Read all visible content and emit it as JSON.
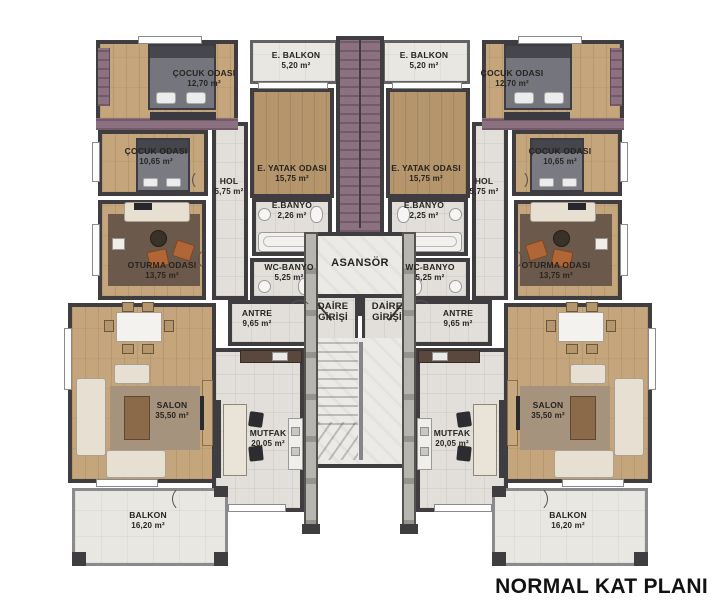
{
  "title": "NORMAL KAT PLANI",
  "core": {
    "asansor_label": "ASANSÖR",
    "daire_line1": "DAİRE",
    "daire_line2": "GİRİŞİ"
  },
  "rooms": {
    "e_balkon": {
      "name": "E. BALKON",
      "area": "5,20 m²"
    },
    "cocuk_buyuk": {
      "name": "ÇOCUK ODASI",
      "area": "12,70 m²"
    },
    "cocuk_kucuk": {
      "name": "ÇOCUK ODASI",
      "area": "10,65 m²"
    },
    "e_yatak": {
      "name": "E. YATAK ODASI",
      "area": "15,75 m²"
    },
    "hol": {
      "name": "HOL",
      "area": "5,75 m²"
    },
    "e_banyo_left": {
      "name": "E.BANYO",
      "area": "2,26 m²"
    },
    "e_banyo_right": {
      "name": "E.BANYO",
      "area": "2,25 m²"
    },
    "wc_banyo": {
      "name": "WC-BANYO",
      "area": "5,25 m²"
    },
    "antre": {
      "name": "ANTRE",
      "area": "9,65 m²"
    },
    "oturma": {
      "name": "OTURMA ODASI",
      "area": "13,75 m²"
    },
    "salon": {
      "name": "SALON",
      "area": "35,50 m²"
    },
    "mutfak": {
      "name": "MUTFAK",
      "area": "20,05 m²"
    },
    "balkon": {
      "name": "BALKON",
      "area": "16,20 m²"
    }
  },
  "colors": {
    "wall": "#3f3d40",
    "wood": "#c4a57c",
    "tile": "#e2dfda",
    "shaft_mauve": "#8c7180",
    "accent_orange": "#b06636",
    "rug_brown": "#6b594b"
  }
}
